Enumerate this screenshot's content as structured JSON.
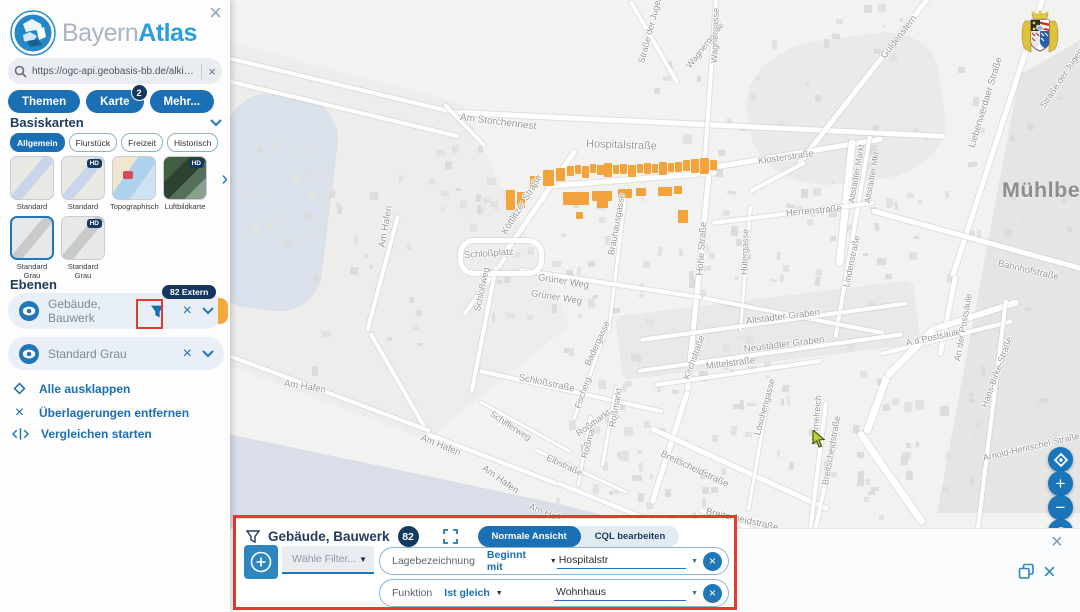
{
  "app": {
    "brand_light": "Bayern",
    "brand_bold": "Atlas"
  },
  "icons": {
    "close": "×",
    "next": "›",
    "dropdown": "▼",
    "plus": "+",
    "minus": "−"
  },
  "sidebar": {
    "search": {
      "value": "https://ogc-api.geobasis-bb.de/alkis-verein"
    },
    "tabs": [
      {
        "label": "Themen"
      },
      {
        "label": "Karte",
        "badge": "2"
      },
      {
        "label": "Mehr..."
      }
    ],
    "basiskarten": {
      "title": "Basiskarten",
      "hd_label": "HD",
      "categories": [
        "Allgemein",
        "Flurstück",
        "Freizeit",
        "Historisch"
      ],
      "maps": [
        {
          "label": "Standard"
        },
        {
          "label": "Standard"
        },
        {
          "label": "Topographisch"
        },
        {
          "label": "Luftbildkarte"
        },
        {
          "label": "Standard Grau"
        },
        {
          "label": "Standard Grau"
        }
      ]
    },
    "ebenen": {
      "title": "Ebenen",
      "layers": [
        {
          "label": "Gebäude, Bauwerk",
          "badge": "82 Extern"
        },
        {
          "label": "Standard Grau"
        }
      ],
      "actions": [
        "Alle ausklappen",
        "Überlagerungen entfernen",
        "Vergleichen starten"
      ]
    }
  },
  "filter_panel": {
    "title": "Gebäude, Bauwerk",
    "count": "82",
    "view_normal": "Normale Ansicht",
    "view_cql": "CQL bearbeiten",
    "filter_select_placeholder": "Wähle Filter...",
    "rows": [
      {
        "field": "Lagebezeichnung",
        "operator": "Beginnt mit",
        "value": "Hospitalstr"
      },
      {
        "field": "Funktion",
        "operator": "Ist gleich",
        "value": "Wohnhaus"
      }
    ]
  },
  "map": {
    "city_label": "Mühlberg",
    "street_labels": [
      {
        "t": "Am Storchennest",
        "x": 460,
        "y": 112,
        "r": 7,
        "s": 10
      },
      {
        "t": "Straße der Jugend",
        "x": 641,
        "y": 58,
        "r": -75,
        "s": 9
      },
      {
        "t": "Straße der Jugend",
        "x": 1042,
        "y": 102,
        "r": -56,
        "s": 9
      },
      {
        "t": "Wagnergasse",
        "x": 688,
        "y": 62,
        "r": -52,
        "s": 9
      },
      {
        "t": "Wagnergasse",
        "x": 714,
        "y": 58,
        "r": -88,
        "s": 9
      },
      {
        "t": "Güldenstern",
        "x": 883,
        "y": 52,
        "r": -52,
        "s": 9.5
      },
      {
        "t": "Liebenwerdaer Straße",
        "x": 972,
        "y": 142,
        "r": -73,
        "s": 9.5
      },
      {
        "t": "Klosterstraße",
        "x": 758,
        "y": 156,
        "r": -8,
        "s": 9.5
      },
      {
        "t": "Hospitalstraße",
        "x": 586,
        "y": 138,
        "r": 2,
        "s": 11
      },
      {
        "t": "Köttlitzer Straße",
        "x": 504,
        "y": 228,
        "r": -58,
        "s": 9.5
      },
      {
        "t": "Herrenstraße",
        "x": 786,
        "y": 208,
        "r": -5,
        "s": 9.5
      },
      {
        "t": "Hohe Straße",
        "x": 700,
        "y": 270,
        "r": -86,
        "s": 9.5
      },
      {
        "t": "Hütergasse",
        "x": 744,
        "y": 270,
        "r": -88,
        "s": 9
      },
      {
        "t": "Altstädter Markt",
        "x": 851,
        "y": 198,
        "r": -80,
        "s": 8.5
      },
      {
        "t": "Altstädter Mkt",
        "x": 867,
        "y": 198,
        "r": -80,
        "s": 8.5
      },
      {
        "t": "Lindenstraße",
        "x": 846,
        "y": 282,
        "r": -78,
        "s": 9
      },
      {
        "t": "Schloßplatz",
        "x": 464,
        "y": 250,
        "r": -4,
        "s": 9.5
      },
      {
        "t": "Grüner Weg",
        "x": 538,
        "y": 272,
        "r": 9,
        "s": 9.5
      },
      {
        "t": "Grüner Weg",
        "x": 531,
        "y": 288,
        "r": 9,
        "s": 9.5
      },
      {
        "t": "Brauhausgasse",
        "x": 611,
        "y": 250,
        "r": -80,
        "s": 9
      },
      {
        "t": "Schloßweg",
        "x": 477,
        "y": 306,
        "r": -78,
        "s": 9
      },
      {
        "t": "Altstädter Graben",
        "x": 746,
        "y": 316,
        "r": -7,
        "s": 9.5
      },
      {
        "t": "Neustädter Graben",
        "x": 744,
        "y": 344,
        "r": -7,
        "s": 9.5
      },
      {
        "t": "Mittelstraße",
        "x": 706,
        "y": 361,
        "r": -7,
        "s": 9.5
      },
      {
        "t": "Kirchstraße",
        "x": 686,
        "y": 374,
        "r": -70,
        "s": 9
      },
      {
        "t": "A.d.Postsäule",
        "x": 906,
        "y": 338,
        "r": -12,
        "s": 9
      },
      {
        "t": "An der Postsäule",
        "x": 957,
        "y": 356,
        "r": -80,
        "s": 9
      },
      {
        "t": "Hans-Birke-Straße",
        "x": 984,
        "y": 402,
        "r": -70,
        "s": 9
      },
      {
        "t": "Bahnhofstraße",
        "x": 998,
        "y": 258,
        "r": 13,
        "s": 9.5
      },
      {
        "t": "Schloßstraße",
        "x": 519,
        "y": 372,
        "r": 12,
        "s": 9.5
      },
      {
        "t": "Badergasse",
        "x": 587,
        "y": 360,
        "r": -65,
        "s": 9
      },
      {
        "t": "Am Hafen",
        "x": 382,
        "y": 242,
        "r": -80,
        "s": 9.5
      },
      {
        "t": "Am Hafen",
        "x": 284,
        "y": 378,
        "r": 9,
        "s": 9.5
      },
      {
        "t": "Am Hafen",
        "x": 421,
        "y": 432,
        "r": 22,
        "s": 9.5
      },
      {
        "t": "Am Hafen",
        "x": 483,
        "y": 462,
        "r": 35,
        "s": 9.5
      },
      {
        "t": "Am Hafen",
        "x": 529,
        "y": 501,
        "r": 22,
        "s": 9.5
      },
      {
        "t": "Schifferweg",
        "x": 491,
        "y": 408,
        "r": 33,
        "s": 9
      },
      {
        "t": "Elbstraße",
        "x": 547,
        "y": 452,
        "r": 25,
        "s": 9
      },
      {
        "t": "Roßmarkt",
        "x": 584,
        "y": 453,
        "r": -75,
        "s": 9
      },
      {
        "t": "Roßmarkt",
        "x": 612,
        "y": 422,
        "r": -80,
        "s": 9
      },
      {
        "t": "Roßmarkt",
        "x": 577,
        "y": 429,
        "r": -35,
        "s": 9
      },
      {
        "t": "Fischerg.",
        "x": 577,
        "y": 403,
        "r": -70,
        "s": 8.5
      },
      {
        "t": "Breitscheidstraße",
        "x": 661,
        "y": 448,
        "r": 25,
        "s": 9.5
      },
      {
        "t": "Breitscheidstraße",
        "x": 706,
        "y": 506,
        "r": 13,
        "s": 9.5
      },
      {
        "t": "Breitscheidstraße",
        "x": 825,
        "y": 480,
        "r": -80,
        "s": 9
      },
      {
        "t": "Löschengasse",
        "x": 757,
        "y": 430,
        "r": -75,
        "s": 9
      },
      {
        "t": "Himmelreich",
        "x": 814,
        "y": 440,
        "r": -85,
        "s": 9
      },
      {
        "t": "Arnold-Hentschel-Straße",
        "x": 983,
        "y": 453,
        "r": -13,
        "s": 9
      }
    ]
  }
}
